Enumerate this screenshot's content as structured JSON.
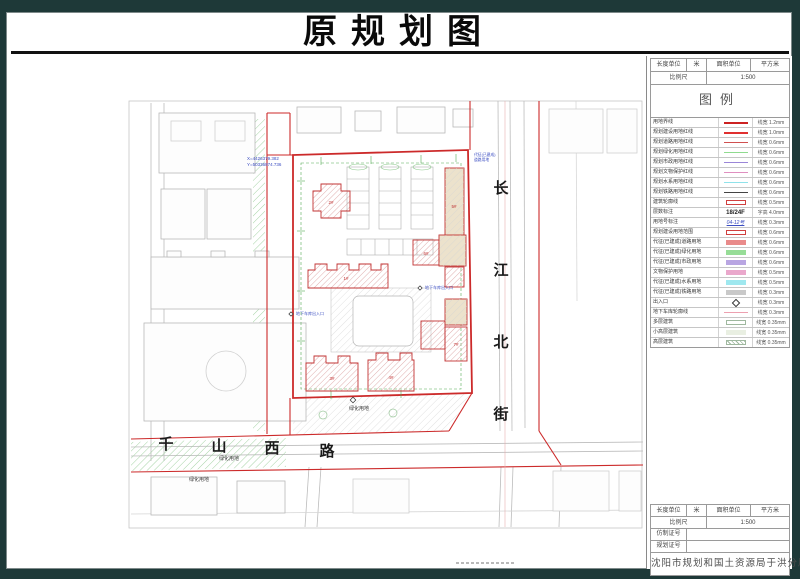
{
  "title": "原规划图",
  "units": {
    "length_label": "长度单位",
    "length_value": "米",
    "area_label": "面积单位",
    "area_value": "平方米",
    "scale_label": "比例尺",
    "scale_value": "1:500"
  },
  "legend": {
    "title": "图例",
    "rows": [
      {
        "label": "用地界线",
        "sym": "line",
        "color": "#cc2222",
        "lw": 2,
        "value": "线宽 1.2mm"
      },
      {
        "label": "规划建设用地红线",
        "sym": "line",
        "color": "#e03030",
        "lw": 2,
        "value": "线宽 1.0mm"
      },
      {
        "label": "规划道路用地红线",
        "sym": "line",
        "color": "#d05050",
        "lw": 1,
        "value": "线宽 0.6mm"
      },
      {
        "label": "规划绿化用地红线",
        "sym": "line",
        "color": "#8fdb8f",
        "lw": 1,
        "value": "线宽 0.6mm"
      },
      {
        "label": "规划市政用地红线",
        "sym": "line",
        "color": "#9b86d8",
        "lw": 1,
        "value": "线宽 0.6mm"
      },
      {
        "label": "规划文物保护红线",
        "sym": "line",
        "color": "#df8fc0",
        "lw": 1,
        "value": "线宽 0.6mm"
      },
      {
        "label": "规划水系用地红线",
        "sym": "line",
        "color": "#8fe2ea",
        "lw": 1,
        "value": "线宽 0.6mm"
      },
      {
        "label": "规划铁路用地红线",
        "sym": "line",
        "color": "#444444",
        "lw": 1,
        "value": "线宽 0.6mm"
      },
      {
        "label": "建筑轮廓线",
        "sym": "rect-outline",
        "color": "#d04040",
        "value": "线宽 0.5mm"
      },
      {
        "label": "层数标注",
        "sym": "text",
        "text": "18/24F",
        "value": "字高 4.0mm"
      },
      {
        "label": "用地号标注",
        "sym": "script",
        "text": "04-12号",
        "color": "#3c4ec2",
        "value": "线宽 0.3mm"
      },
      {
        "label": "规划建设用地范围",
        "sym": "rect-outline",
        "color": "#d04040",
        "value": "线宽 0.6mm"
      },
      {
        "label": "代征(已建成)道路用地",
        "sym": "rect-fill",
        "color": "#e98b8b",
        "value": "线宽 0.6mm"
      },
      {
        "label": "代征(已建成)绿化用地",
        "sym": "rect-fill",
        "color": "#97dd97",
        "value": "线宽 0.6mm"
      },
      {
        "label": "代征(已建成)市政用地",
        "sym": "rect-fill",
        "color": "#b9a6e2",
        "value": "线宽 0.6mm"
      },
      {
        "label": "文物保护用地",
        "sym": "rect-fill",
        "color": "#eaa8cc",
        "value": "线宽 0.5mm"
      },
      {
        "label": "代征(已建成)水系用地",
        "sym": "rect-fill",
        "color": "#9fe8ef",
        "value": "线宽 0.5mm"
      },
      {
        "label": "代征(已建成)铁路用地",
        "sym": "rect-fill",
        "color": "#c9c9c9",
        "value": "线宽 0.3mm"
      },
      {
        "label": "出入口",
        "sym": "diamond",
        "color": "#333333",
        "value": "线宽 0.3mm"
      },
      {
        "label": "地下车库轮廓线",
        "sym": "line",
        "color": "#eda0b0",
        "lw": 1,
        "value": "线宽 0.3mm"
      },
      {
        "label": "多层建筑",
        "sym": "rect-outline",
        "color": "#9fb89f",
        "value": "线宽 0.35mm"
      },
      {
        "label": "小高层建筑",
        "sym": "rect-fill",
        "color": "#e9efe2",
        "value": "线宽 0.35mm"
      },
      {
        "label": "高层建筑",
        "sym": "rect-hatch",
        "color": "#9fb89f",
        "value": "线宽 0.35mm"
      }
    ]
  },
  "title_block": {
    "cert1_label": "仿制证号",
    "cert1_value": "",
    "cert2_label": "规划证号",
    "cert2_value": "",
    "agency": "沈阳市规划和国土资源局于洪分局"
  },
  "map": {
    "street_vertical": [
      "长",
      "江",
      "北",
      "街"
    ],
    "street_horizontal": [
      "千",
      "山",
      "西",
      "路"
    ],
    "labels": {
      "green_area_1": "绿化用地",
      "green_area_2": "绿化用地",
      "green_area_3": "绿化用地",
      "garage_entry_1": "地下车库出入口",
      "garage_entry_2": "地下车库出入口",
      "coord_x": "X=4426379.382",
      "coord_y": "Y=50336874.736",
      "annot_road_line1": "代征(已建成)",
      "annot_road_line2": "道路用地",
      "bldg_1": "1#",
      "bldg_2": "2#",
      "bldg_3": "3#",
      "bldg_4": "4#",
      "bldg_5": "5#",
      "bldg_6": "6#",
      "bldg_7": "7#"
    }
  }
}
